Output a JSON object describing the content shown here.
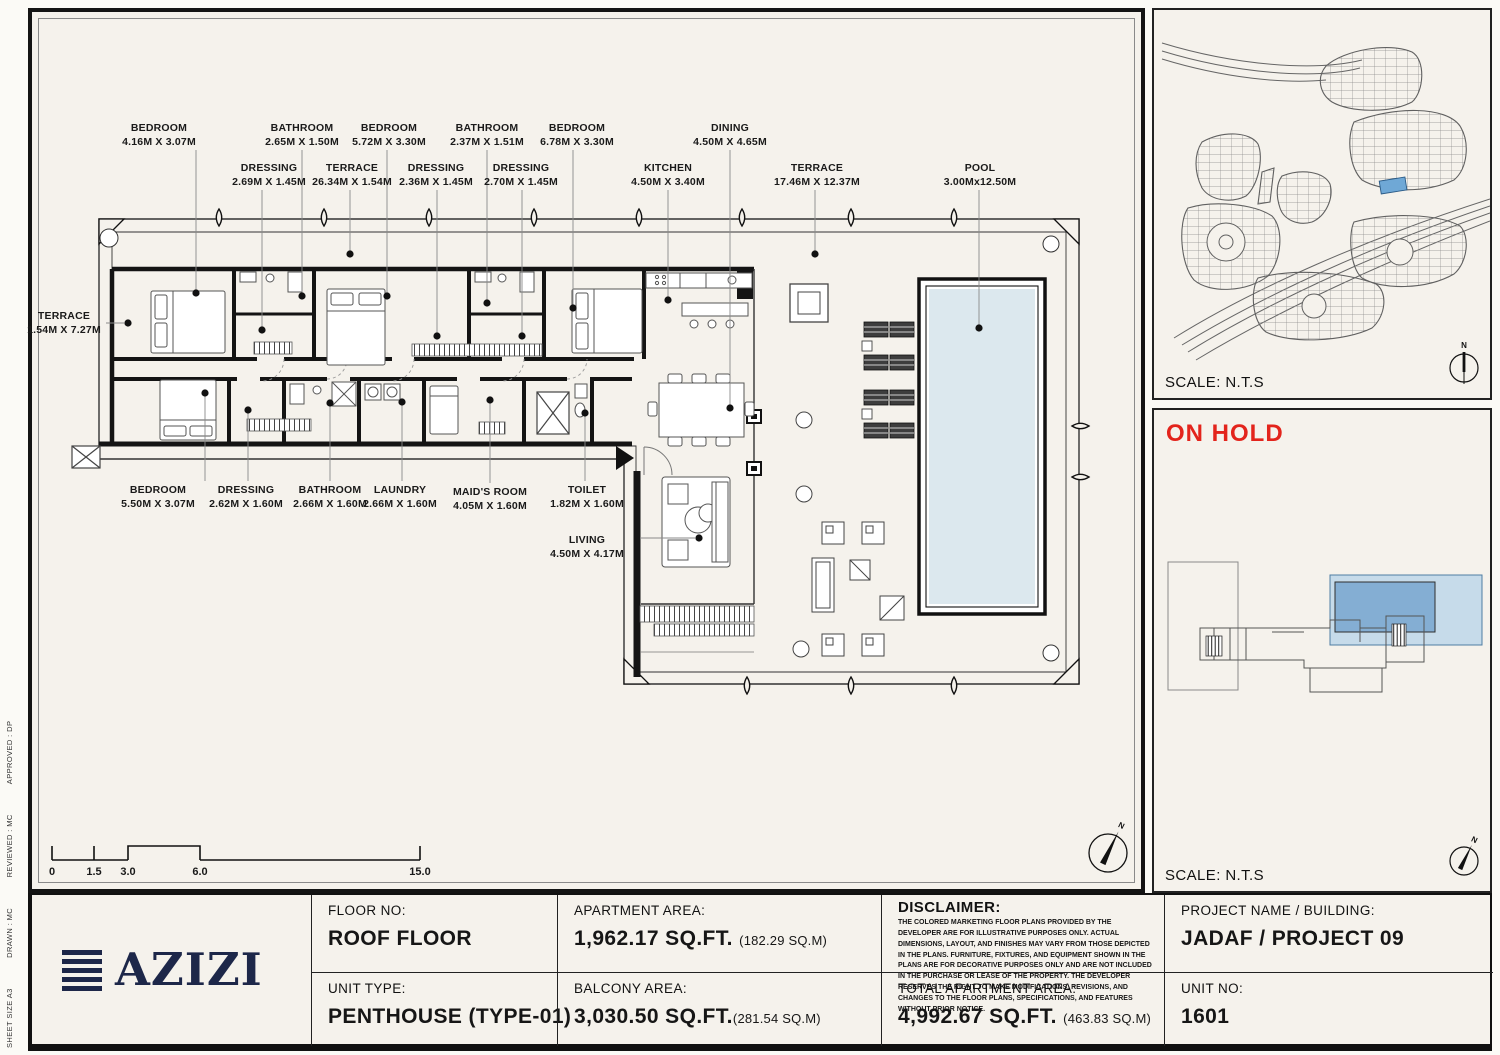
{
  "sheet_strip": {
    "items": [
      "SHEET SIZE A3",
      "DRAWN :  MC",
      "REVIEWED :  MC",
      "APPROVED :  DP"
    ]
  },
  "plan": {
    "labels": [
      {
        "name": "BEDROOM",
        "dims": "4.16M X 3.07M"
      },
      {
        "name": "BATHROOM",
        "dims": "2.65M X 1.50M"
      },
      {
        "name": "BEDROOM",
        "dims": "5.72M X 3.30M"
      },
      {
        "name": "BATHROOM",
        "dims": "2.37M X 1.51M"
      },
      {
        "name": "BEDROOM",
        "dims": "6.78M X 3.30M"
      },
      {
        "name": "DINING",
        "dims": "4.50M X 4.65M"
      },
      {
        "name": "DRESSING",
        "dims": "2.69M X 1.45M"
      },
      {
        "name": "TERRACE",
        "dims": "26.34M X 1.54M"
      },
      {
        "name": "DRESSING",
        "dims": "2.36M X 1.45M"
      },
      {
        "name": "DRESSING",
        "dims": "2.70M X 1.45M"
      },
      {
        "name": "KITCHEN",
        "dims": "4.50M X 3.40M"
      },
      {
        "name": "TERRACE",
        "dims": "17.46M X 12.37M"
      },
      {
        "name": "POOL",
        "dims": "3.00Mx12.50M"
      },
      {
        "name": "TERRACE",
        "dims": "1.54M X 7.27M"
      },
      {
        "name": "BEDROOM",
        "dims": "5.50M X 3.07M"
      },
      {
        "name": "DRESSING",
        "dims": "2.62M X 1.60M"
      },
      {
        "name": "BATHROOM",
        "dims": "2.66M X 1.60M"
      },
      {
        "name": "LAUNDRY",
        "dims": "2.66M X 1.60M"
      },
      {
        "name": "MAID'S ROOM",
        "dims": "4.05M X 1.60M"
      },
      {
        "name": "TOILET",
        "dims": "1.82M X 1.60M"
      },
      {
        "name": "LIVING",
        "dims": "4.50M X 4.17M"
      }
    ],
    "scale_bar": {
      "ticks": [
        "0",
        "1.5",
        "3.0",
        "6.0",
        "15.0"
      ]
    },
    "compass_label": "N"
  },
  "map_panel": {
    "scale_label": "SCALE: N.T.S",
    "compass_label": "N"
  },
  "status_panel": {
    "status": "ON HOLD",
    "scale_label": "SCALE: N.T.S",
    "compass_label": "N"
  },
  "title_block": {
    "logo_text": "AZIZI",
    "floor": {
      "label": "FLOOR NO:",
      "value": "ROOF FLOOR"
    },
    "unit_type": {
      "label": "UNIT TYPE:",
      "value": "PENTHOUSE (TYPE-01)"
    },
    "apartment_area": {
      "label": "APARTMENT AREA:",
      "value": "1,962.17 SQ.FT.",
      "metric": "(182.29 SQ.M)"
    },
    "balcony_area": {
      "label": "BALCONY AREA:",
      "value": "3,030.50 SQ.FT.",
      "metric": "(281.54 SQ.M)"
    },
    "disclaimer": {
      "label": "DISCLAIMER:",
      "body": "THE COLORED MARKETING FLOOR PLANS PROVIDED BY THE DEVELOPER ARE FOR ILLUSTRATIVE PURPOSES ONLY. ACTUAL DIMENSIONS, LAYOUT, AND FINISHES MAY VARY FROM THOSE DEPICTED IN THE PLANS. FURNITURE, FIXTURES, AND EQUIPMENT SHOWN IN THE PLANS ARE FOR DECORATIVE PURPOSES ONLY AND ARE NOT INCLUDED IN THE PURCHASE OR LEASE OF THE PROPERTY. THE DEVELOPER RESERVES THE RIGHT TO MAKE MODIFICATIONS, REVISIONS, AND CHANGES TO THE FLOOR PLANS, SPECIFICATIONS, AND FEATURES WITHOUT PRIOR NOTICE."
    },
    "total_area": {
      "label": "TOTAL APARTMENT AREA:",
      "value": "4,992.67 SQ.FT.",
      "metric": "(463.83 SQ.M)"
    },
    "project": {
      "label": "PROJECT NAME / BUILDING:",
      "value": "JADAF / PROJECT 09"
    },
    "unit_no": {
      "label": "UNIT NO:",
      "value": "1601"
    }
  },
  "colors": {
    "paper": "#f5f2ec",
    "ink": "#161616",
    "pool_water": "#dce8ee",
    "map_highlight": "#6fa8d6",
    "keyplan_light_blue": "#c6dbea",
    "keyplan_mid_blue": "#84aed3",
    "status_red": "#e3241c",
    "logo_navy": "#1d2749"
  }
}
